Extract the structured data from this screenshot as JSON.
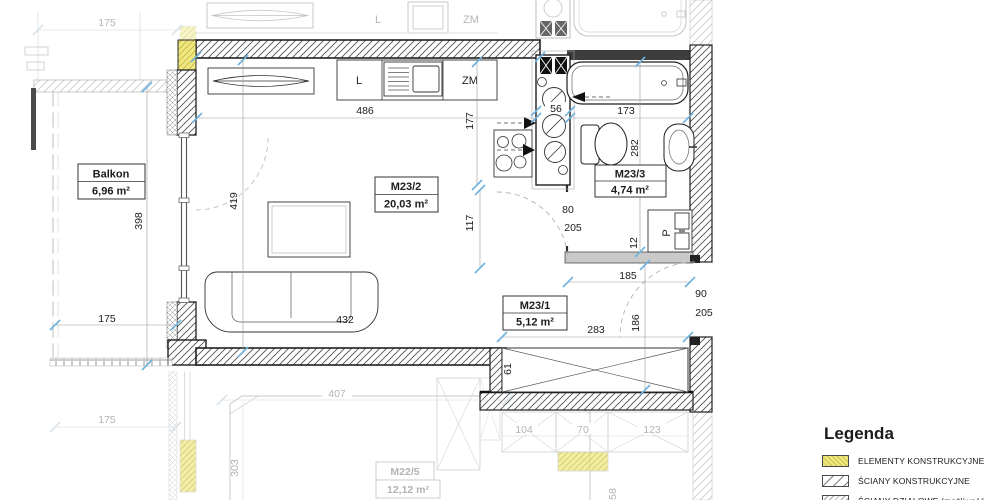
{
  "plan": {
    "rooms": {
      "living": {
        "name": "M23/2",
        "area": "20,03 m²"
      },
      "bath": {
        "name": "M23/3",
        "area": "4,74 m²"
      },
      "hall": {
        "name": "M23/1",
        "area": "5,12 m²"
      },
      "balcony": {
        "name": "Balkon",
        "area": "6,96 m²"
      },
      "neighbor_below": {
        "name": "M22/5",
        "area": "12,12 m²"
      }
    },
    "appliances": {
      "fridge": "L",
      "dishwasher": "ZM",
      "washer": "P",
      "fridge_neighbor": "L",
      "dishwasher_neighbor": "ZM"
    },
    "dims": {
      "d486": "486",
      "d177": "177",
      "d56": "56",
      "d173": "173",
      "d282": "282",
      "d117": "117",
      "d80": "80",
      "d205_bath": "205",
      "d12": "12",
      "d185": "185",
      "d90": "90",
      "d205_entry": "205",
      "d283": "283",
      "d186": "186",
      "d61": "61",
      "d432": "432",
      "d419": "419",
      "d398": "398",
      "d175_balcony": "175",
      "d175_top": "175",
      "d175_bottom": "175",
      "d407": "407",
      "d303": "303",
      "d104": "104",
      "d70": "70",
      "d123": "123",
      "d58": "58"
    }
  },
  "legend": {
    "title": "Legenda",
    "items": [
      {
        "label": "ELEMENTY KONSTRUKCYJNE"
      },
      {
        "label": "ŚCIANY KONSTRUKCYJNE"
      },
      {
        "label": "ŚCIANY DZIAŁOWE (możliwość"
      }
    ]
  },
  "colors": {
    "structural_yellow": "#efe87b",
    "tick_blue": "#6fb3dc",
    "faded_gray": "#b9b9b9",
    "line_dark": "#1c1c1c"
  }
}
